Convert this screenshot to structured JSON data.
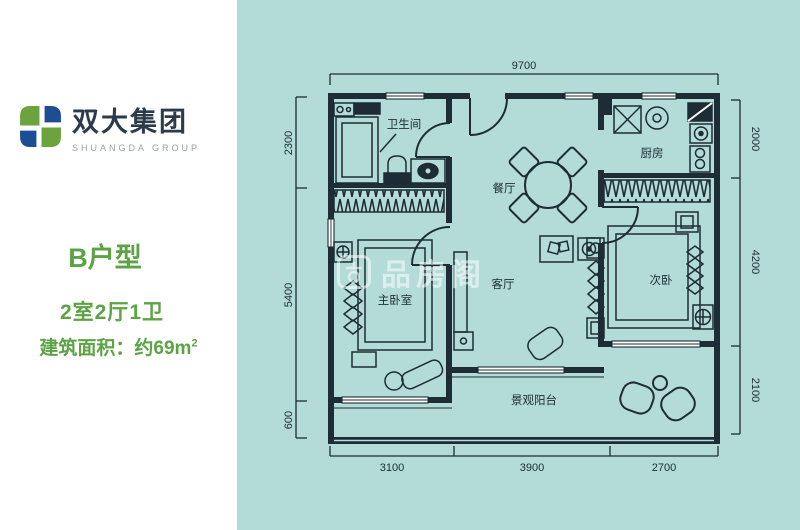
{
  "colors": {
    "background": "#b3dbd7",
    "panel": "#ffffff",
    "plan_line": "#1d2c35",
    "green_text": "#5ca344",
    "logo_green": "#6da33e",
    "logo_blue": "#1d4e94"
  },
  "brand": {
    "name_cn": "双大集团",
    "name_en": "SHUANGDA GROUP"
  },
  "unit": {
    "type": "B户型",
    "rooms": "2室2厅1卫",
    "area_prefix": "建筑面积：约69m",
    "area_sup": "2"
  },
  "floorplan": {
    "rooms": {
      "bathroom": "卫生间",
      "dining": "餐厅",
      "kitchen": "厨房",
      "master_bedroom": "主卧室",
      "living_room": "客厅",
      "second_bedroom": "次卧",
      "balcony": "景观阳台"
    },
    "dimensions": {
      "top": "9700",
      "bottom": [
        "3100",
        "3900",
        "2700"
      ],
      "left": [
        "2300",
        "5400",
        "600"
      ],
      "right": [
        "2000",
        "4200",
        "2100"
      ]
    }
  },
  "watermark": {
    "text": "品房阁"
  }
}
